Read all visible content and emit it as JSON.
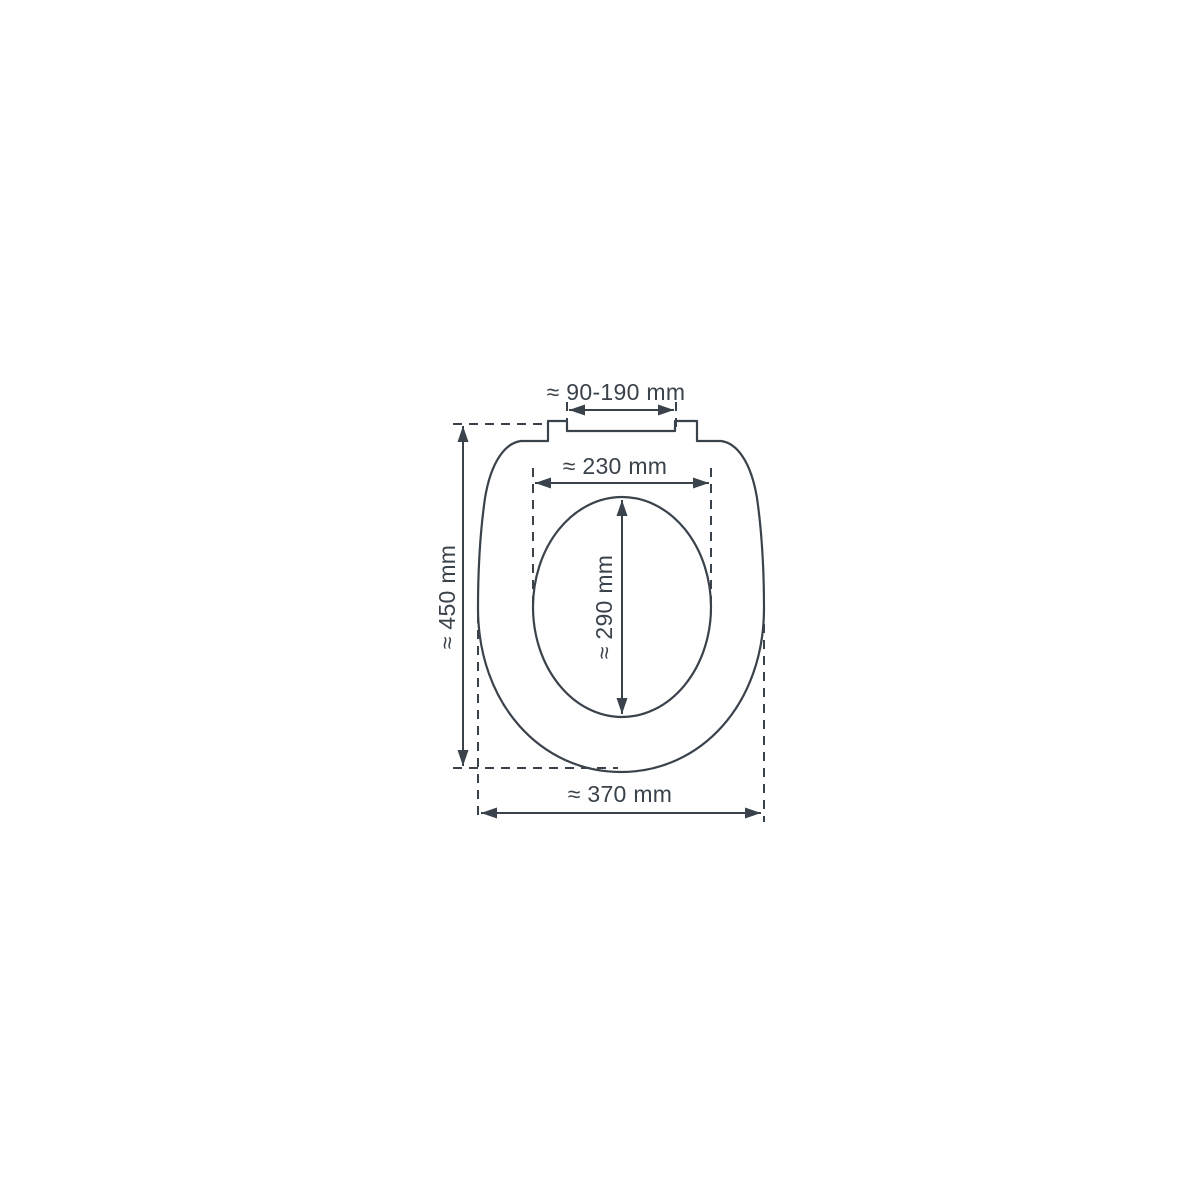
{
  "page": {
    "background_color": "#ffffff"
  },
  "diagram": {
    "kind": "technical-dimension-drawing",
    "subject": "toilet-seat-top-view",
    "line_color": "#3a424b",
    "labels": {
      "hinge_span": "≈ 90-190 mm",
      "inner_width": "≈ 230 mm",
      "outer_length": "≈ 450 mm",
      "inner_length": "≈ 290 mm",
      "outer_width": "≈ 370 mm"
    }
  }
}
